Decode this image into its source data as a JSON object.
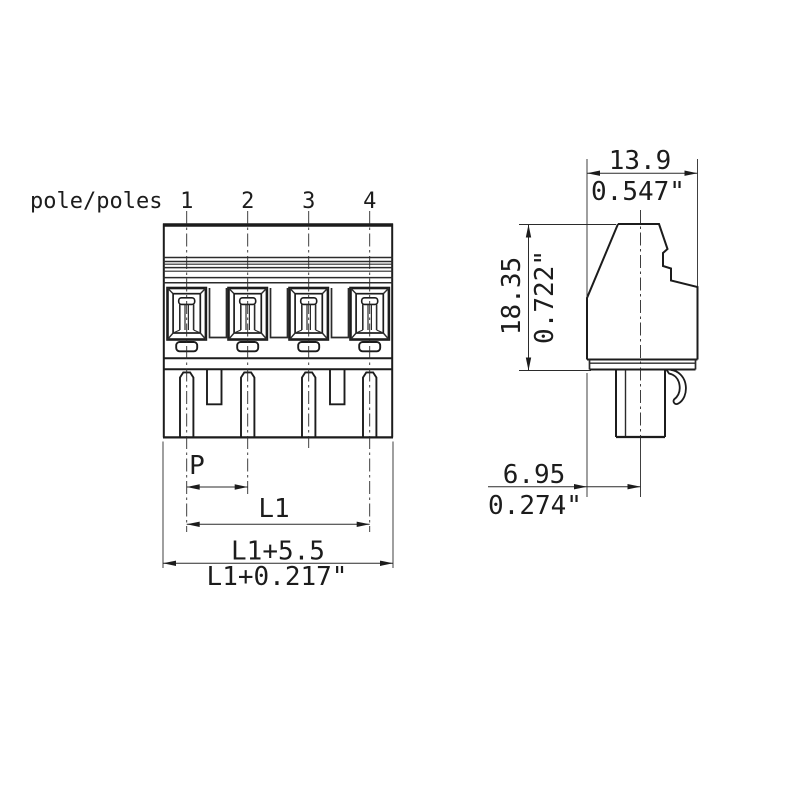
{
  "drawing": {
    "kind": "terminal-block-connector-dimension-drawing",
    "front_view": {
      "poles_label": "pole/poles",
      "pole_numbers": [
        "1",
        "2",
        "3",
        "4"
      ],
      "dim_pitch": "P",
      "dim_length": "L1",
      "dim_overall_mm": "L1+5.5",
      "dim_overall_inch": "L1+0.217\""
    },
    "side_view": {
      "dim_width_mm": "13.9",
      "dim_width_inch": "0.547\"",
      "dim_height_mm": "18.35",
      "dim_height_inch": "0.722\"",
      "dim_pin_offset_mm": "6.95",
      "dim_pin_offset_inch": "0.274\""
    },
    "colors": {
      "line": "#1c1c1c",
      "background": "#ffffff"
    }
  }
}
